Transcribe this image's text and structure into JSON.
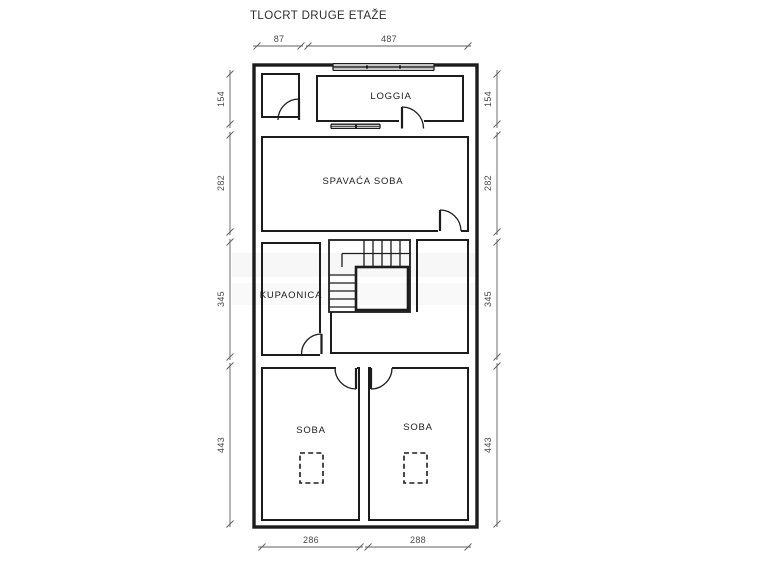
{
  "title": "TLOCRT DRUGE ETAŽE",
  "rooms": {
    "loggia": "LOGGIA",
    "bedroom": "SPAVAĆA SOBA",
    "bathroom": "KUPAONICA",
    "room_left": "SOBA",
    "room_right": "SOBA"
  },
  "dimensions": {
    "top": [
      {
        "label": "87"
      },
      {
        "label": "487"
      }
    ],
    "left": [
      {
        "label": "154"
      },
      {
        "label": "282"
      },
      {
        "label": "345"
      },
      {
        "label": "443"
      }
    ],
    "right": [
      {
        "label": "154"
      },
      {
        "label": "282"
      },
      {
        "label": "345"
      },
      {
        "label": "443"
      }
    ],
    "bottom": [
      {
        "label": "286"
      },
      {
        "label": "288"
      }
    ]
  },
  "colors": {
    "wall_line": "#1c1c1c",
    "dimension_line": "#5f5f5f",
    "background": "#ffffff"
  }
}
